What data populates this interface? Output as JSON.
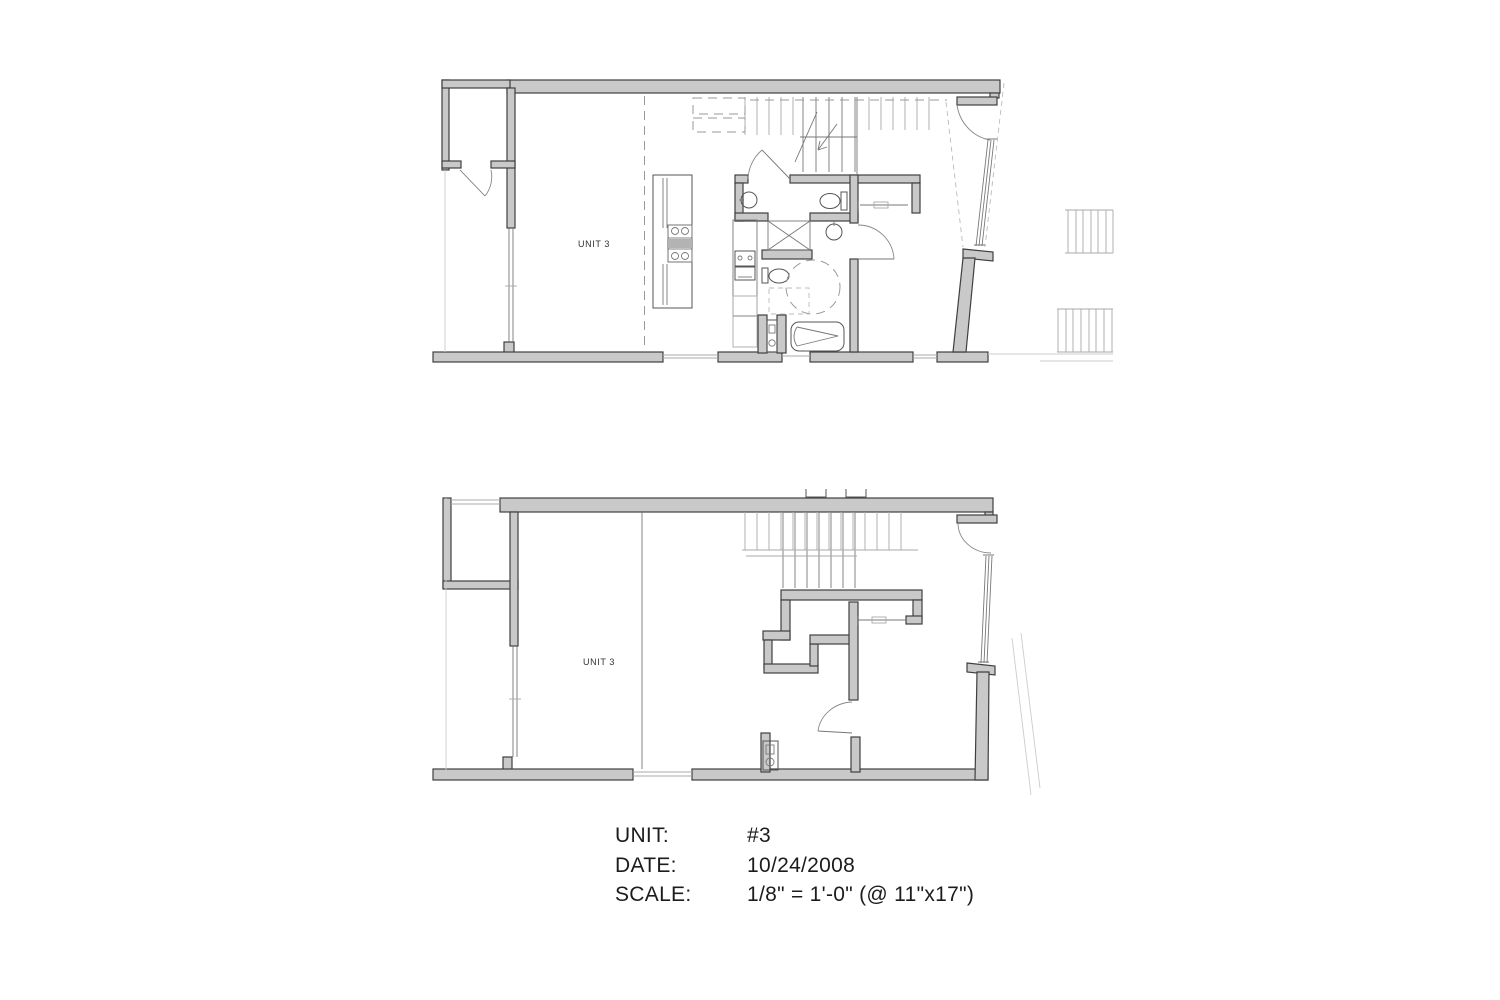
{
  "page": {
    "background": "#ffffff"
  },
  "drawing": {
    "plans": [
      {
        "name": "upper-floor-plan",
        "label": "UNIT 3",
        "symbols": [
          "entry-closet-door",
          "kitchen-island",
          "cooktop",
          "range-oven",
          "powder-sink",
          "toilet",
          "vanity-sink",
          "shower-x",
          "accessible-turning-circle",
          "bathtub",
          "toilet-2",
          "stairs-up",
          "closet-rod",
          "entry-door",
          "slanted-window",
          "balcony-railing-1",
          "balcony-railing-2",
          "demising-dashed-line",
          "upper-cabinets-dashed"
        ]
      },
      {
        "name": "lower-floor-plan",
        "label": "UNIT 3",
        "symbols": [
          "stairs",
          "pocket-door",
          "interior-door",
          "water-heater",
          "entry-door",
          "slanted-window",
          "demising-wall",
          "window-strip"
        ]
      }
    ],
    "colors": {
      "wall_fill": "#c9c9c9",
      "wall_outline": "#3f3f3f",
      "fixture_line": "#666666",
      "light_line": "#aaaaaa",
      "dashed_line": "#999999",
      "text": "#1c1c1c"
    }
  },
  "title_block": {
    "rows": [
      {
        "label": "UNIT:",
        "value": "#3"
      },
      {
        "label": "DATE:",
        "value": "10/24/2008"
      },
      {
        "label": "SCALE:",
        "value": "1/8\" = 1'-0\" (@ 11\"x17\")"
      }
    ]
  }
}
